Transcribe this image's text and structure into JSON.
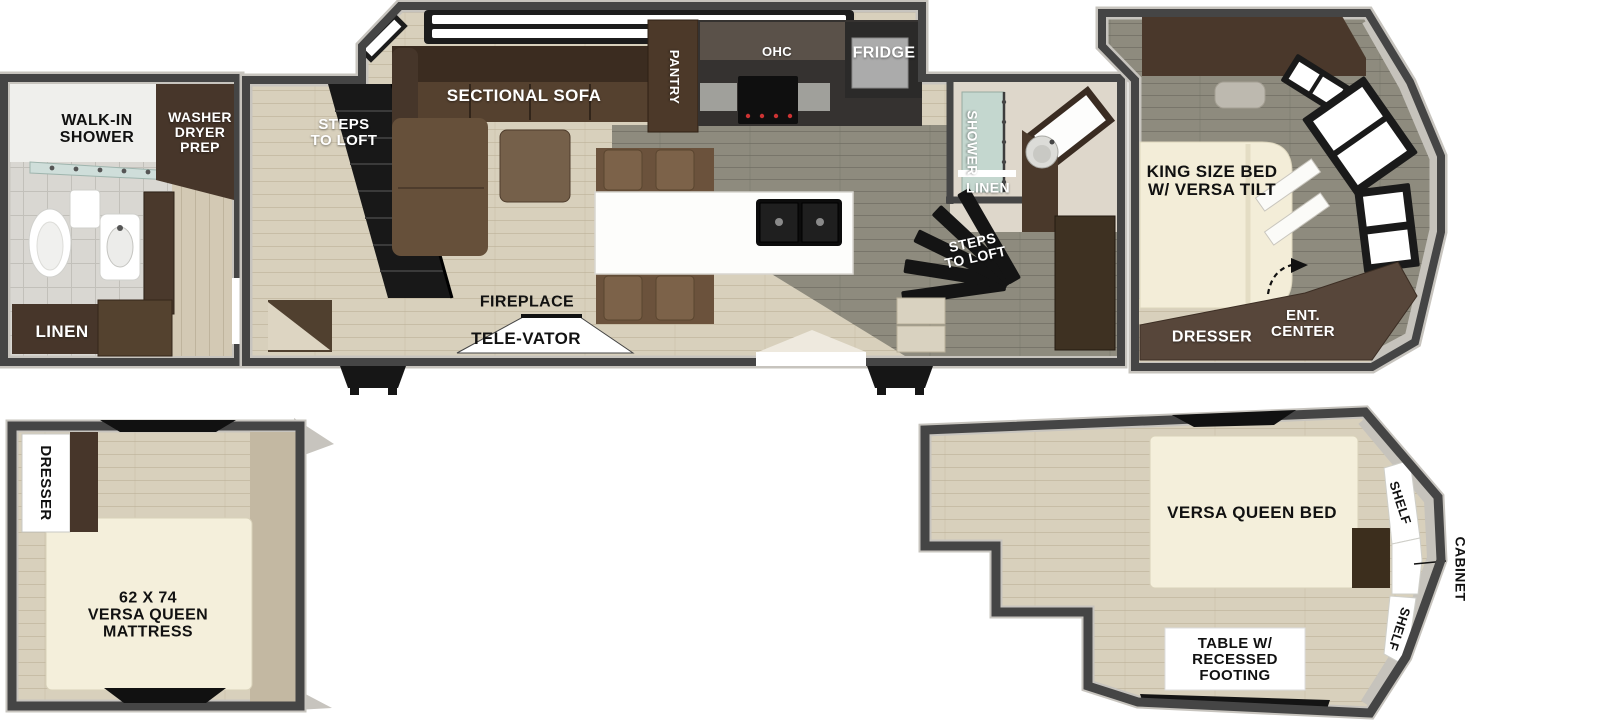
{
  "colors": {
    "wall": "#454545",
    "wall_rim": "#c7c4be",
    "floor_wood": "#d8d0bc",
    "floor_gray": "#8e8b7e",
    "cabinet_brown": "#4a382b",
    "sofa_brown": "#55412f",
    "bedding_cream": "#f3edd8",
    "island_white": "#fdfdfb",
    "accent_black": "#141414",
    "label_dark": "#111111",
    "label_light": "#ffffff"
  },
  "main_floor": {
    "rear_bath": {
      "walk_in_shower": [
        "WALK-IN",
        "SHOWER"
      ],
      "washer_dryer_prep": [
        "WASHER",
        "DRYER",
        "PREP"
      ],
      "linen": "LINEN"
    },
    "living": {
      "steps_to_loft": [
        "STEPS",
        "TO LOFT"
      ],
      "sectional_sofa": "SECTIONAL SOFA",
      "fireplace": "FIREPLACE",
      "tele_vator": "TELE-VATOR"
    },
    "kitchen": {
      "pantry": "PANTRY",
      "ohc": "OHC",
      "fridge": "FRIDGE"
    },
    "mid_bath": {
      "shower": "SHOWER",
      "linen": "LINEN"
    },
    "hall": {
      "steps_to_loft": [
        "STEPS",
        "TO LOFT"
      ]
    },
    "bedroom": {
      "king_bed": [
        "KING SIZE BED",
        "W/ VERSA TILT"
      ],
      "dresser": "DRESSER",
      "ent_center": [
        "ENT.",
        "CENTER"
      ]
    }
  },
  "rear_loft": {
    "dresser": "DRESSER",
    "mattress": [
      "62 X 74",
      "VERSA QUEEN",
      "MATTRESS"
    ]
  },
  "front_loft": {
    "bed": "VERSA QUEEN BED",
    "shelf_top": "SHELF",
    "shelf_bottom": "SHELF",
    "cabinet": "CABINET",
    "table": [
      "TABLE W/",
      "RECESSED",
      "FOOTING"
    ]
  }
}
